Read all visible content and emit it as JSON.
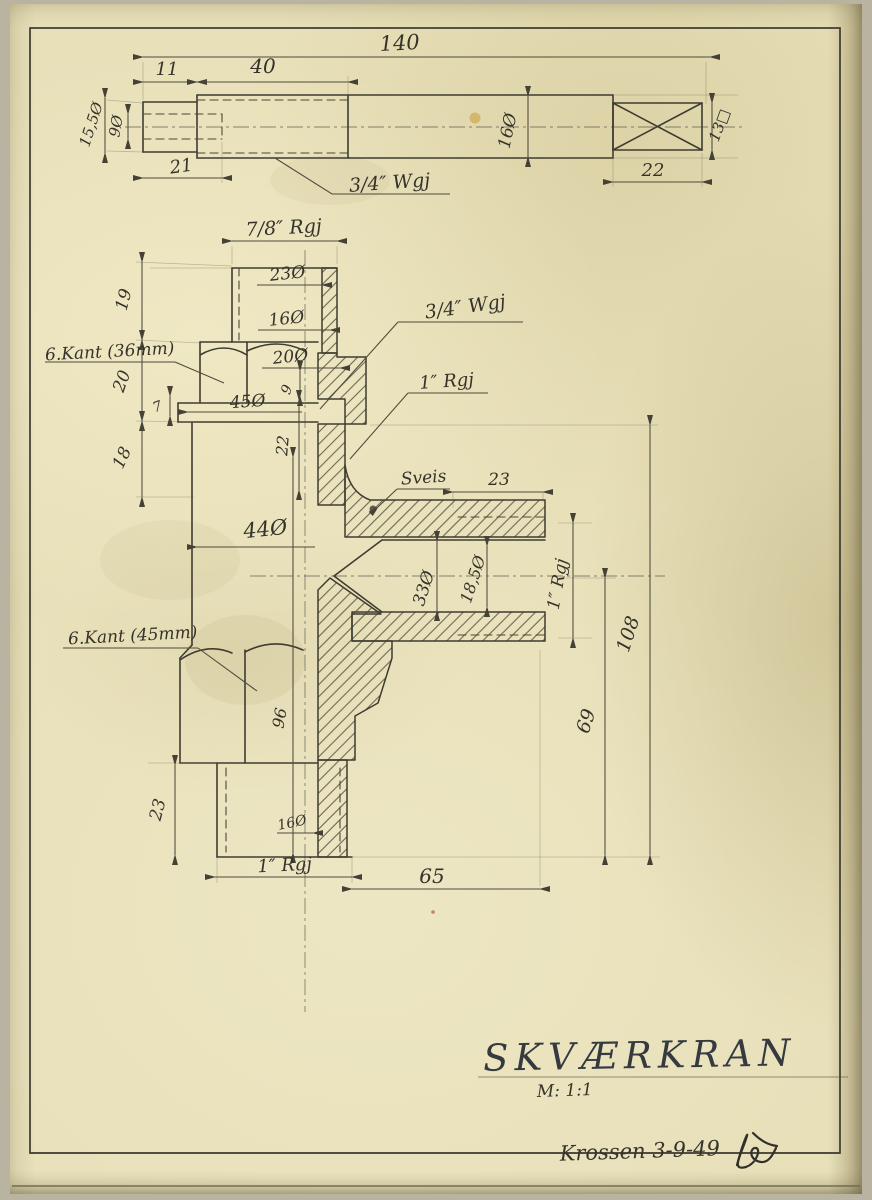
{
  "title_block": {
    "title": "SKVÆRKRAN",
    "scale": "M: 1:1",
    "signed": "Krossen 3-9-49"
  },
  "top_view": {
    "thread_label": "3/4″ Wgj",
    "dims": {
      "overall": "140",
      "stub_len": "11",
      "thread_len": "40",
      "hole_depth": "21",
      "square_len": "22",
      "rod_dia": "16Ø",
      "stub_dia": "15,5Ø",
      "hole_dia": "9Ø",
      "square_size": "13□"
    }
  },
  "main_view": {
    "labels": {
      "stem_thread": "7/8″ Rgj",
      "stem_thread2": "3/4″ Wgj",
      "pipe_thread": "1″ Rgj",
      "weld": "Sveis",
      "hex_small": "6.Kant (36mm)",
      "hex_large": "6.Kant (45mm)"
    },
    "dims": {
      "stem_od": "23Ø",
      "stem_mid": "16Ø",
      "stem_base": "20Ø",
      "step": "9",
      "flange_dia": "45Ø",
      "flange_thk": "7",
      "stem_len": "19",
      "hex_h": "20",
      "neck_h": "18",
      "bore_depth": "22",
      "body_dia": "44Ø",
      "spout_thread_len": "23",
      "spout_od": "33Ø",
      "spout_bore": "18,5Ø",
      "spout_thread": "1″ Rgj",
      "h_center": "69",
      "h_total": "108",
      "bore_len": "96",
      "outlet_bore": "16Ø",
      "outlet_len": "23",
      "outlet_thread": "1″ Rgj",
      "offset": "65"
    }
  }
}
